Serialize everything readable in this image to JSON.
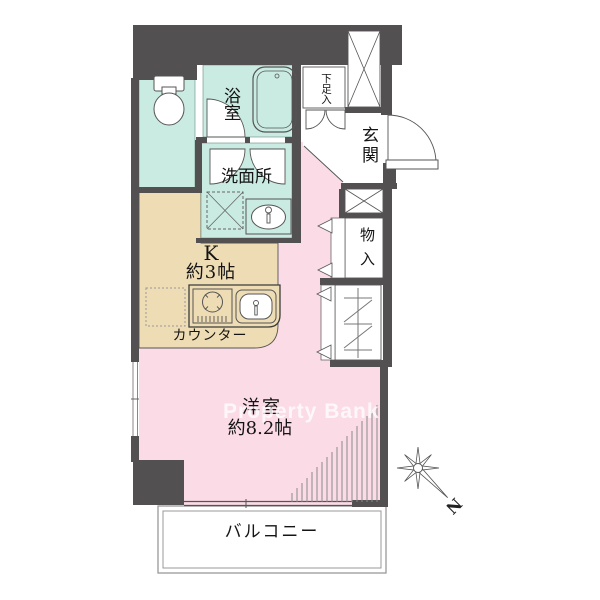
{
  "floor_plan": {
    "watermark": "Property Bank",
    "bathroom_label": "浴室",
    "washroom_label": "洗面所",
    "shoe_cabinet_label": "下足入",
    "entrance_label": "玄関",
    "storage_label": "物入",
    "kitchen_name": "K",
    "kitchen_size": "約3帖",
    "counter_label": "カウンター",
    "main_room_name": "洋室",
    "main_room_size": "約8.2帖",
    "balcony_label": "バルコニー",
    "compass_north": "N",
    "colors": {
      "wall": "#535052",
      "wet_area_fill": "#c9ebe2",
      "kitchen_fill": "#eedcb4",
      "room_fill": "#fbdce6",
      "watermark": "#ffffff"
    }
  }
}
